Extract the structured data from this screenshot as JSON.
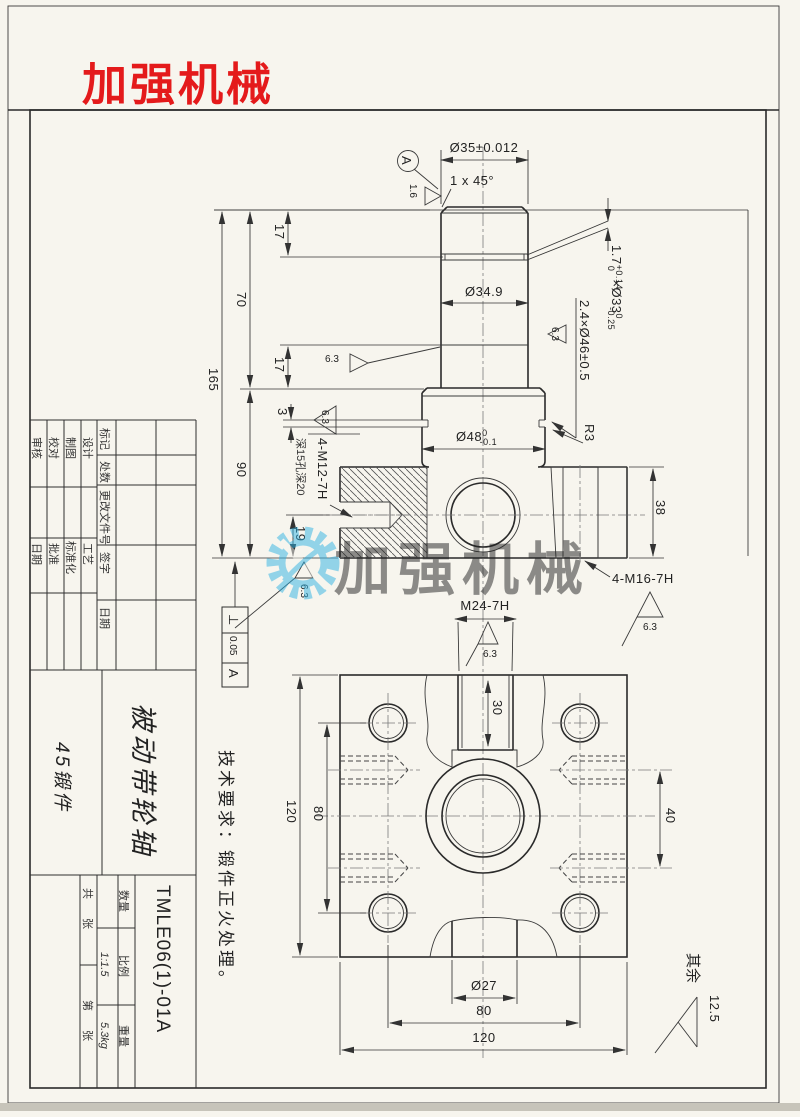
{
  "branding": {
    "logo_text": "加强机械",
    "watermark_text": "加强机械"
  },
  "notes": {
    "tech_requirements": "技术要求：锻件正火处理。",
    "default_roughness_label": "其余",
    "default_roughness_value": "12.5"
  },
  "shaft_view": {
    "datum": "A",
    "rough_a": "1.6",
    "rough_63": "6.3",
    "dim_d35": "Ø35±0.012",
    "chamfer": "1 x 45°",
    "groove1": {
      "nominal": "1.7",
      "tol_up": "+0.14",
      "tol_dn": "0",
      "dia": "×Ø33",
      "dia_tol_up": "0",
      "dia_tol_dn": "-0.25"
    },
    "dim_d349": "Ø34.9",
    "groove2": "2.4×Ø46±0.5",
    "dim_17_top": "17",
    "dim_70": "70",
    "dim_165": "165",
    "dim_17_mid": "17",
    "dim_3": "3",
    "dim_90": "90",
    "dim_19": "19",
    "d48": {
      "nominal": "Ø48",
      "tol_up": "0",
      "tol_dn": "-0.1"
    },
    "r3": "R3",
    "dim_38": "38",
    "m12_note": "4-M12-7H",
    "m12_depth": "深15孔深20",
    "m16_note": "4-M16-7H",
    "m24_note": "M24-7H",
    "gdt": {
      "symbol": "⊥",
      "value": "0.05",
      "datum": "A"
    }
  },
  "flange_view": {
    "dim_30": "30",
    "dim_120_left": "120",
    "dim_80_left": "80",
    "dim_40": "40",
    "dim_d27": "Ø27",
    "dim_80_bottom": "80",
    "dim_120_bottom": "120"
  },
  "title_block": {
    "revision_headers": [
      "标记",
      "处数",
      "更改文件号",
      "签字",
      "日期"
    ],
    "role_row1": [
      "审核",
      "校对",
      "制图",
      "设计"
    ],
    "role_row2": [
      "日期",
      "批准",
      "标准化",
      "工艺"
    ],
    "part_name": "被动带轮轴",
    "material": "45锻件",
    "drawing_number": "TMLE06(1)-01A",
    "qty_label": "数量",
    "scale_label": "比例",
    "scale_value": "1:1.5",
    "weight_label": "重量",
    "weight_value": "5.3kg",
    "sheets_total": "共  张",
    "sheet_index": "第  张"
  }
}
